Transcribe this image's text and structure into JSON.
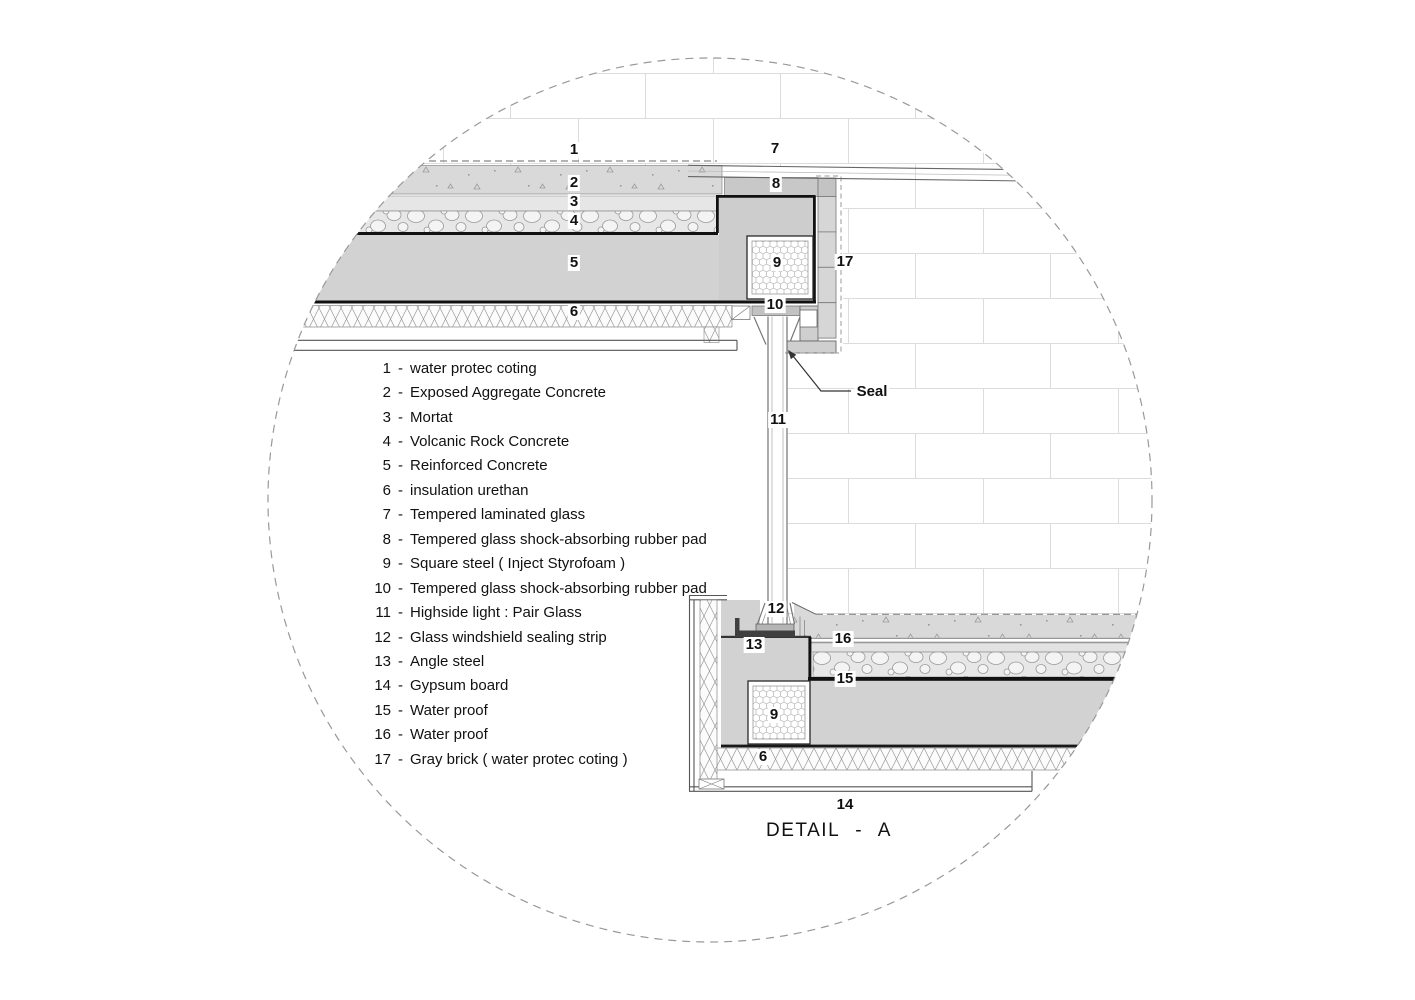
{
  "drawing_title": "DETAIL - A",
  "legend": {
    "separator": "-",
    "items": [
      {
        "num": "1",
        "text": "water protec coting"
      },
      {
        "num": "2",
        "text": "Exposed Aggregate Concrete"
      },
      {
        "num": "3",
        "text": "Mortat"
      },
      {
        "num": "4",
        "text": "Volcanic Rock Concrete"
      },
      {
        "num": "5",
        "text": "Reinforced Concrete"
      },
      {
        "num": "6",
        "text": "insulation urethan"
      },
      {
        "num": "7",
        "text": "Tempered laminated glass"
      },
      {
        "num": "8",
        "text": "Tempered glass shock-absorbing rubber pad"
      },
      {
        "num": "9",
        "text": "Square steel  ( Inject Styrofoam )"
      },
      {
        "num": "10",
        "text": "Tempered glass shock-absorbing rubber pad"
      },
      {
        "num": "11",
        "text": "Highside light : Pair Glass"
      },
      {
        "num": "12",
        "text": "Glass windshield sealing strip"
      },
      {
        "num": "13",
        "text": "Angle steel"
      },
      {
        "num": "14",
        "text": "Gypsum board"
      },
      {
        "num": "15",
        "text": "Water proof"
      },
      {
        "num": "16",
        "text": "Water proof"
      },
      {
        "num": "17",
        "text": "Gray brick ( water protec coting )"
      }
    ]
  },
  "callouts": [
    {
      "id": "roof-water-coating",
      "label": "1"
    },
    {
      "id": "glass-top",
      "label": "7"
    },
    {
      "id": "aggregate-concrete",
      "label": "2"
    },
    {
      "id": "rubber-pad-top",
      "label": "8"
    },
    {
      "id": "mortar",
      "label": "3"
    },
    {
      "id": "volcanic-concrete",
      "label": "4"
    },
    {
      "id": "reinforced-concrete",
      "label": "5"
    },
    {
      "id": "square-steel-upper",
      "label": "9"
    },
    {
      "id": "gray-brick-column",
      "label": "17"
    },
    {
      "id": "insulation-upper",
      "label": "6"
    },
    {
      "id": "rubber-pad-bottom",
      "label": "10"
    },
    {
      "id": "highside-light-glass",
      "label": "11"
    },
    {
      "id": "seal-annotation",
      "label": "Seal"
    },
    {
      "id": "sealing-strip",
      "label": "12"
    },
    {
      "id": "angle-steel",
      "label": "13"
    },
    {
      "id": "waterproof-16",
      "label": "16"
    },
    {
      "id": "waterproof-15",
      "label": "15"
    },
    {
      "id": "square-steel-lower",
      "label": "9"
    },
    {
      "id": "insulation-lower",
      "label": "6"
    },
    {
      "id": "gypsum-board",
      "label": "14"
    }
  ],
  "colors": {
    "concrete_gray": "#d2d2d2",
    "outline_black": "#111111",
    "steel_dark": "#3f3f3f",
    "hatch_line": "#9a9a9a",
    "brick_joint_line": "#dcdcdc",
    "dashed_boundary": "#999999"
  }
}
